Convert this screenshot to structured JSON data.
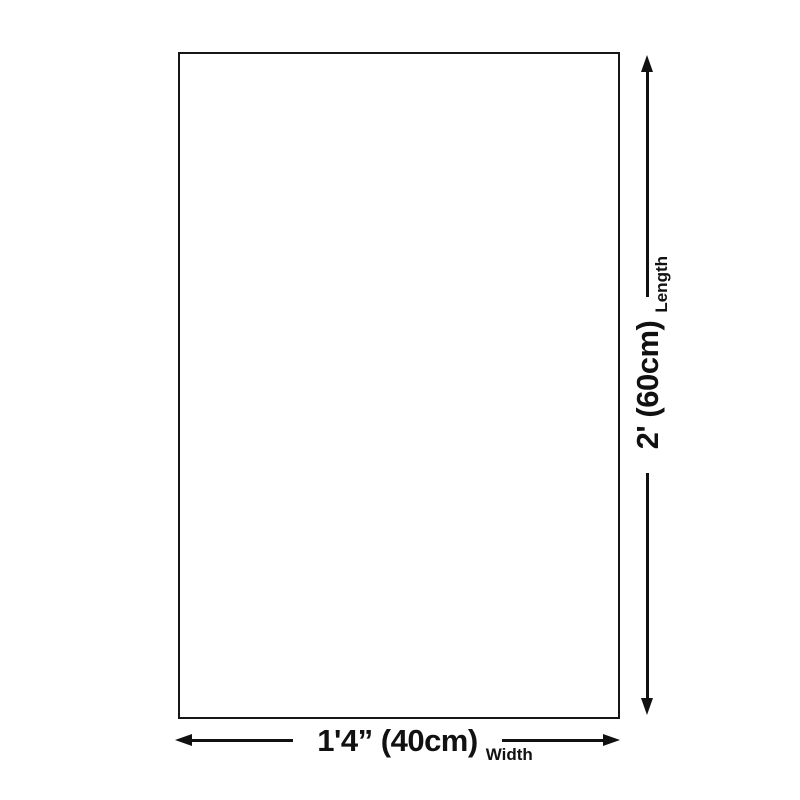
{
  "canvas": {
    "background_color": "#ffffff",
    "stroke_color": "#111111",
    "description": "Product size diagram: blank rectangle with length and width dimension arrows"
  },
  "rectangle": {
    "name": "product-outline"
  },
  "dimensions": {
    "width": {
      "value": "1'4” (40cm)",
      "axis": "Width"
    },
    "length": {
      "value": "2' (60cm)",
      "axis": "Length"
    }
  },
  "icons": {
    "width_start": "arrow-left",
    "width_end": "arrow-right",
    "length_start": "arrow-down",
    "length_end": "arrow-up"
  }
}
